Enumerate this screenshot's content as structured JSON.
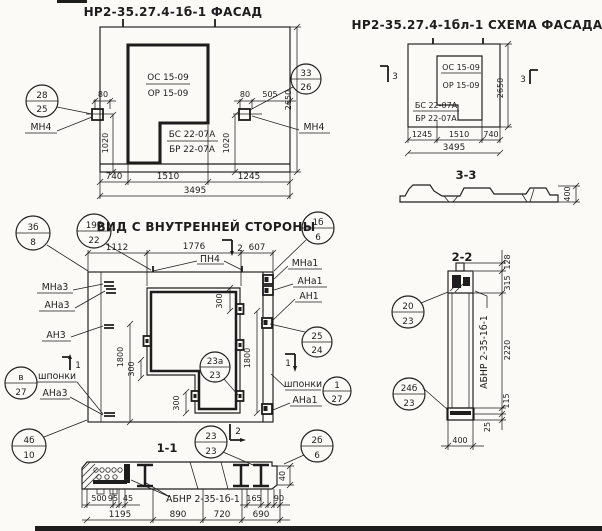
{
  "page": {
    "paper_color": "#fbfaf6",
    "ink_color": "#1d1d1d"
  },
  "facade": {
    "title": "НР2-35.27.4-1б-1 ФАСАД",
    "window_labels": {
      "os": "ОС 15-09",
      "or": "ОР 15-09",
      "bs": "БС 22-07А",
      "br": "БР 22-07А"
    },
    "anchor_label_left": "МН4",
    "anchor_label_right": "МН4",
    "circle_left": {
      "top": "28",
      "bottom": "25"
    },
    "circle_right": {
      "top": "33",
      "bottom": "26"
    },
    "dims": {
      "left_80": "80",
      "right_80": "80",
      "right_505": "505",
      "left_1020": "1020",
      "right_1020": "1020",
      "height_2650": "2650",
      "w740": "740",
      "w1510": "1510",
      "w1245": "1245",
      "total_3495": "3495"
    }
  },
  "schema": {
    "title": "НР2-35.27.4-1бл-1 СХЕМА ФАСАДА",
    "window_labels": {
      "os": "ОС 15-09",
      "or": "ОР 15-09",
      "bs": "БС 22-07А",
      "br": "БР 22-07А"
    },
    "section_flag_left": "3",
    "section_flag_right": "3",
    "dims": {
      "height_2650": "2650",
      "w1245": "1245",
      "w1510": "1510",
      "w740": "740",
      "total_3495": "3495"
    }
  },
  "section33": {
    "title": "3-3",
    "dims": {
      "h400": "400"
    }
  },
  "inner": {
    "title": "ВИД С ВНУТРЕННЕЙ СТОРОНЫ",
    "top_anchor_label": "ПН4",
    "labels_left": {
      "mna3": "МНа3",
      "ana3": "АНа3",
      "an3": "АН3",
      "shponki": "шпонки",
      "ana3_b": "АНа3"
    },
    "labels_right": {
      "mna1": "МНа1",
      "ana1": "АНа1",
      "an1": "АН1",
      "shponki": "шпонки",
      "ana1_b": "АНа1"
    },
    "flags": {
      "top": "2",
      "bottom": "2",
      "left": "1",
      "right": "1"
    },
    "circles": {
      "c3b8": {
        "top": "3б",
        "bottom": "8"
      },
      "c19b22": {
        "top": "19б",
        "bottom": "22"
      },
      "c1b6": {
        "top": "1б",
        "bottom": "6"
      },
      "c25_24": {
        "top": "25",
        "bottom": "24"
      },
      "c1_27": {
        "top": "1",
        "bottom": "27"
      },
      "cv27": {
        "top": "в",
        "bottom": "27"
      },
      "c4b10": {
        "top": "4б",
        "bottom": "10"
      },
      "c23a23": {
        "top": "23а",
        "bottom": "23"
      },
      "c23_23": {
        "top": "23",
        "bottom": "23"
      },
      "c2b6": {
        "top": "2б",
        "bottom": "6"
      }
    },
    "dims": {
      "w1112": "1112",
      "w1776": "1776",
      "w607": "607",
      "h1800_left": "1800",
      "h1800_right": "1800",
      "d300_top": "300",
      "d300_mid": "300",
      "d300_bot": "300"
    }
  },
  "section11": {
    "title": "1-1",
    "part_label": "АБНР 2-35-1б-1",
    "dims": {
      "d500": "500",
      "d95": "95",
      "d45": "45",
      "d165": "165",
      "d90": "90",
      "d40": "40",
      "w1195": "1195",
      "w890": "890",
      "w720": "720",
      "w690": "690"
    }
  },
  "section22": {
    "title": "2-2",
    "part_label": "АБНР 2-35-1б-1",
    "circles": {
      "c20_23": {
        "top": "20",
        "bottom": "23"
      },
      "c24b23": {
        "top": "24б",
        "bottom": "23"
      }
    },
    "dims": {
      "d128": "128",
      "d315": "315",
      "d2220": "2220",
      "d115": "115",
      "d25": "25",
      "w400": "400"
    }
  }
}
